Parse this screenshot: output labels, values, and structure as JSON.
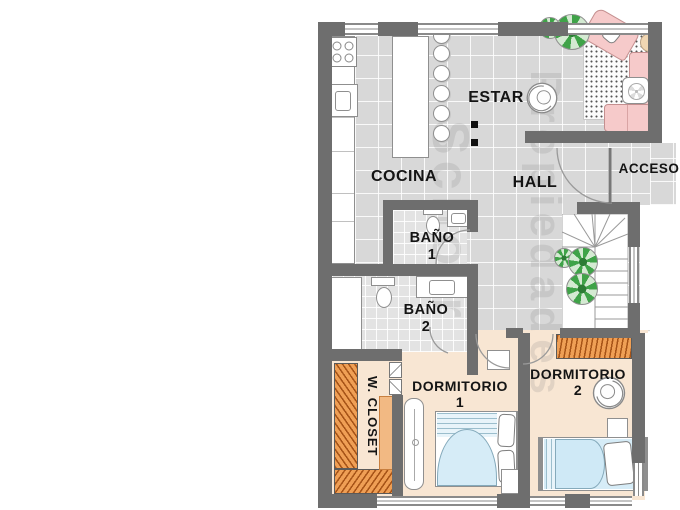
{
  "rooms": {
    "estar": {
      "label": "ESTAR"
    },
    "cocina": {
      "label": "COCINA"
    },
    "hall": {
      "label": "HALL"
    },
    "acceso": {
      "label": "ACCESO"
    },
    "bano1": {
      "label": "BAÑO",
      "number": "1"
    },
    "bano2": {
      "label": "BAÑO",
      "number": "2"
    },
    "closet": {
      "label": "W. CLOSET"
    },
    "dorm1": {
      "label": "DORMITORIO",
      "number": "1"
    },
    "dorm2": {
      "label": "DORMITORIO",
      "number": "2"
    }
  },
  "watermark": {
    "line1": "Schorr",
    "line2": "Propiedades"
  },
  "colors": {
    "wall": "#6e6e6e",
    "tile_floor": "#d8d8d8",
    "bath_tile": "#e3e3e3",
    "bedroom_floor": "#f8e6d3",
    "closet_wood": "#ef9f55",
    "bed_blue": "#d6ecf7",
    "sofa_pink": "#f6caca",
    "plant_green": "#3fa348"
  }
}
